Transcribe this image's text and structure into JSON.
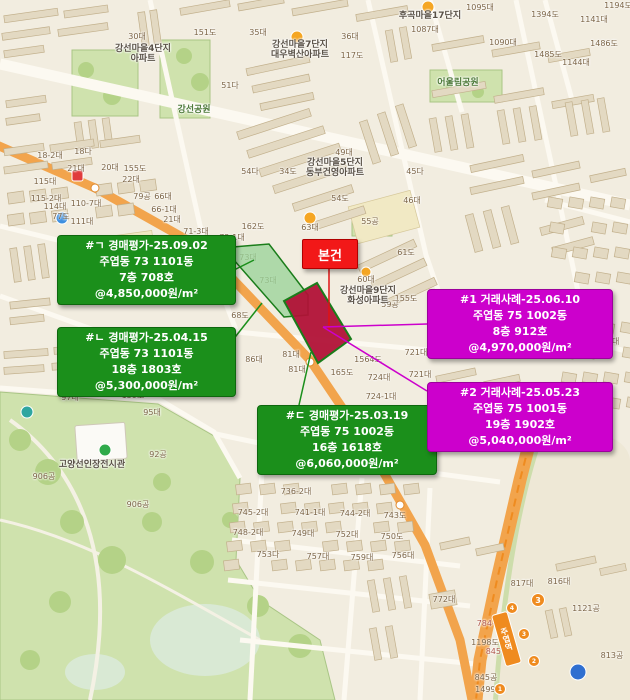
{
  "subject": {
    "label": "본건"
  },
  "annotations": {
    "auction": [
      {
        "header": "#ㄱ 경매평가-25.09.02",
        "address": "주엽동 73 1101동",
        "floor_unit": "7층 708호",
        "unit_price": "@4,850,000원/m²"
      },
      {
        "header": "#ㄴ 경매평가-25.04.15",
        "address": "주엽동 73 1101동",
        "floor_unit": "18층 1803호",
        "unit_price": "@5,300,000원/m²"
      },
      {
        "header": "#ㄷ 경매평가-25.03.19",
        "address": "주엽동 75 1002동",
        "floor_unit": "16층 1618호",
        "unit_price": "@6,060,000원/m²"
      }
    ],
    "transaction": [
      {
        "header": "#1 거래사례-25.06.10",
        "address": "주엽동 75 1002동",
        "floor_unit": "8층 912호",
        "unit_price": "@4,970,000원/m²"
      },
      {
        "header": "#2 거래사례-25.05.23",
        "address": "주엽동 75 1001동",
        "floor_unit": "19층 1902호",
        "unit_price": "@5,040,000원/m²"
      }
    ]
  },
  "colors": {
    "map_bg": "#f2ede0",
    "building_fill": "#e3d9c2",
    "building_stroke": "#c2b08c",
    "road_minor": "#fcf9f1",
    "road_major": "#f2a44c",
    "park": "#cfe2ad",
    "park_dark": "#b4d287",
    "water": "#d9e9d4",
    "lot_text": "#7c6547",
    "lot_text_red": "#b0594e",
    "complex_text": "#5a5248",
    "park_text": "#4e7a3a",
    "green": "#1b8f1b",
    "green_border": "#0e670e",
    "magenta": "#cc00cc",
    "magenta_border": "#9c009c",
    "red": "#f21818",
    "subject_parcel": "#b11237",
    "comp_parcel": "#9bd49a",
    "metro_orange": "#ef8b1f"
  },
  "map": {
    "subway": {
      "station": "주엽역",
      "line": "3",
      "exits": [
        {
          "n": "4",
          "x": 512,
          "y": 608
        },
        {
          "n": "3",
          "x": 524,
          "y": 634
        },
        {
          "n": "2",
          "x": 534,
          "y": 661
        },
        {
          "n": "1",
          "x": 500,
          "y": 689
        }
      ]
    },
    "place_labels": [
      {
        "kind": "complex",
        "x": 300,
        "y": 50,
        "lines": [
          "강선마을7단지",
          "대우벽산아파트"
        ]
      },
      {
        "kind": "complex",
        "x": 335,
        "y": 168,
        "lines": [
          "강선마을5단지",
          "동부건영아파트"
        ]
      },
      {
        "kind": "complex",
        "x": 368,
        "y": 296,
        "lines": [
          "강선마을9단지",
          "화성아파트"
        ]
      },
      {
        "kind": "complex",
        "x": 430,
        "y": 16,
        "lines": [
          "후곡마을17단지"
        ]
      },
      {
        "kind": "complex",
        "x": 143,
        "y": 54,
        "lines": [
          "강선마을4단지",
          "아파트"
        ]
      },
      {
        "kind": "park",
        "x": 458,
        "y": 83,
        "lines": [
          "어울림공원"
        ]
      },
      {
        "kind": "park",
        "x": 194,
        "y": 110,
        "lines": [
          "강선공원"
        ]
      },
      {
        "kind": "complex",
        "x": 92,
        "y": 465,
        "lines": [
          "고양선인장전시관"
        ]
      }
    ],
    "lot_labels": [
      {
        "t": "30대",
        "x": 137,
        "y": 37
      },
      {
        "t": "151도",
        "x": 205,
        "y": 33
      },
      {
        "t": "35대",
        "x": 258,
        "y": 33
      },
      {
        "t": "36대",
        "x": 350,
        "y": 37
      },
      {
        "t": "117도",
        "x": 352,
        "y": 56
      },
      {
        "t": "51다",
        "x": 230,
        "y": 86
      },
      {
        "t": "1095대",
        "x": 480,
        "y": 8
      },
      {
        "t": "1394도",
        "x": 545,
        "y": 15
      },
      {
        "t": "1141대",
        "x": 594,
        "y": 20
      },
      {
        "t": "1194도",
        "x": 618,
        "y": 6
      },
      {
        "t": "1087대",
        "x": 425,
        "y": 30
      },
      {
        "t": "1090대",
        "x": 503,
        "y": 43
      },
      {
        "t": "1485도",
        "x": 548,
        "y": 55
      },
      {
        "t": "1486도",
        "x": 604,
        "y": 44
      },
      {
        "t": "1144대",
        "x": 576,
        "y": 63
      },
      {
        "t": "49대",
        "x": 344,
        "y": 153
      },
      {
        "t": "34도",
        "x": 288,
        "y": 172
      },
      {
        "t": "45다",
        "x": 415,
        "y": 172
      },
      {
        "t": "54도",
        "x": 340,
        "y": 199
      },
      {
        "t": "46대",
        "x": 412,
        "y": 201
      },
      {
        "t": "63대",
        "x": 310,
        "y": 228
      },
      {
        "t": "162도",
        "x": 253,
        "y": 227
      },
      {
        "t": "54다",
        "x": 250,
        "y": 172
      },
      {
        "t": "18-2대",
        "x": 50,
        "y": 156
      },
      {
        "t": "18다",
        "x": 83,
        "y": 152
      },
      {
        "t": "21대",
        "x": 76,
        "y": 169
      },
      {
        "t": "20대",
        "x": 110,
        "y": 168
      },
      {
        "t": "155도",
        "x": 135,
        "y": 169
      },
      {
        "t": "115대",
        "x": 45,
        "y": 182
      },
      {
        "t": "22대",
        "x": 131,
        "y": 180
      },
      {
        "t": "79공",
        "x": 142,
        "y": 197
      },
      {
        "t": "66대",
        "x": 163,
        "y": 197
      },
      {
        "t": "115-2대",
        "x": 46,
        "y": 199
      },
      {
        "t": "110-7대",
        "x": 86,
        "y": 204
      },
      {
        "t": "114대",
        "x": 55,
        "y": 207
      },
      {
        "t": "66-1대",
        "x": 164,
        "y": 210
      },
      {
        "t": "77도",
        "x": 61,
        "y": 217
      },
      {
        "t": "111대",
        "x": 82,
        "y": 222
      },
      {
        "t": "21대",
        "x": 172,
        "y": 220
      },
      {
        "t": "71-3대",
        "x": 196,
        "y": 232
      },
      {
        "t": "72-1대",
        "x": 232,
        "y": 238
      },
      {
        "t": "73대",
        "x": 248,
        "y": 258
      },
      {
        "t": "73대",
        "x": 268,
        "y": 281
      },
      {
        "t": "61도",
        "x": 406,
        "y": 253
      },
      {
        "t": "60대",
        "x": 366,
        "y": 280
      },
      {
        "t": "155도",
        "x": 406,
        "y": 299
      },
      {
        "t": "59공",
        "x": 390,
        "y": 305
      },
      {
        "t": "55공",
        "x": 370,
        "y": 222
      },
      {
        "t": "68도",
        "x": 240,
        "y": 316
      },
      {
        "t": "84대",
        "x": 223,
        "y": 347
      },
      {
        "t": "81대",
        "x": 291,
        "y": 355
      },
      {
        "t": "86대",
        "x": 254,
        "y": 360
      },
      {
        "t": "81대",
        "x": 297,
        "y": 370
      },
      {
        "t": "1564도",
        "x": 368,
        "y": 360
      },
      {
        "t": "721대",
        "x": 416,
        "y": 353
      },
      {
        "t": "721대",
        "x": 420,
        "y": 375
      },
      {
        "t": "165도",
        "x": 342,
        "y": 373
      },
      {
        "t": "724대",
        "x": 379,
        "y": 378
      },
      {
        "t": "724-1대",
        "x": 381,
        "y": 397
      },
      {
        "t": "725대",
        "x": 403,
        "y": 430
      },
      {
        "t": "266대",
        "x": 608,
        "y": 342
      },
      {
        "t": "736-2대",
        "x": 296,
        "y": 492
      },
      {
        "t": "745-2대",
        "x": 253,
        "y": 513
      },
      {
        "t": "741-1대",
        "x": 310,
        "y": 513
      },
      {
        "t": "744-2대",
        "x": 355,
        "y": 514
      },
      {
        "t": "743도",
        "x": 395,
        "y": 516
      },
      {
        "t": "748-2대",
        "x": 248,
        "y": 533
      },
      {
        "t": "749대",
        "x": 303,
        "y": 534
      },
      {
        "t": "752대",
        "x": 347,
        "y": 535
      },
      {
        "t": "750도",
        "x": 392,
        "y": 537
      },
      {
        "t": "753다",
        "x": 268,
        "y": 555
      },
      {
        "t": "757대",
        "x": 318,
        "y": 557
      },
      {
        "t": "759대",
        "x": 362,
        "y": 558
      },
      {
        "t": "756대",
        "x": 403,
        "y": 556
      },
      {
        "t": "97대",
        "x": 70,
        "y": 398
      },
      {
        "t": "159도",
        "x": 133,
        "y": 396
      },
      {
        "t": "95대",
        "x": 152,
        "y": 413
      },
      {
        "t": "92공",
        "x": 158,
        "y": 455
      },
      {
        "t": "906공",
        "x": 44,
        "y": 477
      },
      {
        "t": "906공",
        "x": 138,
        "y": 505
      },
      {
        "t": "772대",
        "x": 444,
        "y": 600
      },
      {
        "t": "817대",
        "x": 522,
        "y": 584
      },
      {
        "t": "816대",
        "x": 559,
        "y": 582
      },
      {
        "t": "1121공",
        "x": 586,
        "y": 609
      },
      {
        "t": "784-1대",
        "x": 492,
        "y": 624,
        "c": "red"
      },
      {
        "t": "1198도",
        "x": 485,
        "y": 643
      },
      {
        "t": "845-4대",
        "x": 501,
        "y": 652,
        "c": "red"
      },
      {
        "t": "813공",
        "x": 612,
        "y": 656
      },
      {
        "t": "845공",
        "x": 486,
        "y": 678
      },
      {
        "t": "1499도",
        "x": 489,
        "y": 690
      }
    ]
  }
}
